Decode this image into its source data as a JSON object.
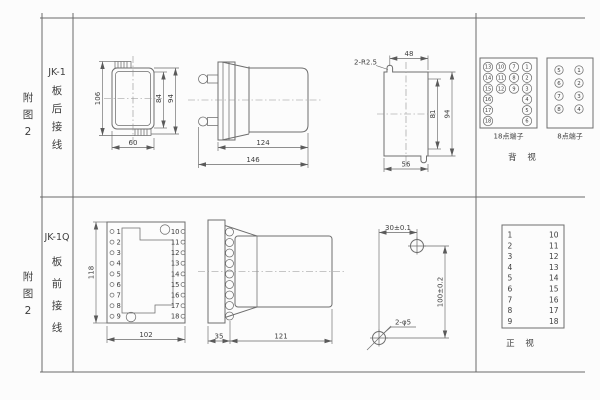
{
  "row1": {
    "fig": [
      "附",
      "图",
      "2"
    ],
    "model": "JK-1",
    "wiring": [
      "板",
      "后",
      "接",
      "线"
    ],
    "rear_view": {
      "height": "106",
      "inner_height": "84",
      "outer_height": "94",
      "width": "60"
    },
    "side_view": {
      "body_depth": "124",
      "total_depth": "146"
    },
    "cutout": {
      "note": "2-R2.5",
      "top": "48",
      "inner": "81",
      "outer": "94",
      "bottom": "56"
    },
    "t18": {
      "label": "18点端子",
      "colA": [
        "13",
        "14",
        "15",
        "16",
        "17",
        "18"
      ],
      "colB": [
        "10",
        "11",
        "12"
      ],
      "colC": [
        "7",
        "8",
        "9"
      ],
      "colD": [
        "1",
        "2",
        "3",
        "4",
        "5",
        "6"
      ]
    },
    "t8": {
      "label": "8点端子",
      "left": [
        "5",
        "6",
        "7",
        "8"
      ],
      "right": [
        "1",
        "2",
        "3",
        "4"
      ]
    },
    "view_label": "背 视"
  },
  "row2": {
    "fig": [
      "附",
      "图",
      "2"
    ],
    "model": "JK-1Q",
    "wiring": [
      "板",
      "前",
      "接",
      "线"
    ],
    "panel": {
      "height": "118",
      "width": "102",
      "left": [
        "1",
        "2",
        "3",
        "4",
        "5",
        "6",
        "7",
        "8",
        "9"
      ],
      "right": [
        "10",
        "11",
        "12",
        "13",
        "14",
        "15",
        "16",
        "17",
        "18"
      ]
    },
    "side_view": {
      "front_depth": "35",
      "body_depth": "121"
    },
    "drill": {
      "dim_h": "30±0.1",
      "dim_v": "100±0.2",
      "holes": "2-φ5"
    },
    "table": {
      "left": [
        "1",
        "2",
        "3",
        "4",
        "5",
        "6",
        "7",
        "8",
        "9"
      ],
      "right": [
        "10",
        "11",
        "12",
        "13",
        "14",
        "15",
        "16",
        "17",
        "18"
      ],
      "view_label": "正 视"
    }
  }
}
